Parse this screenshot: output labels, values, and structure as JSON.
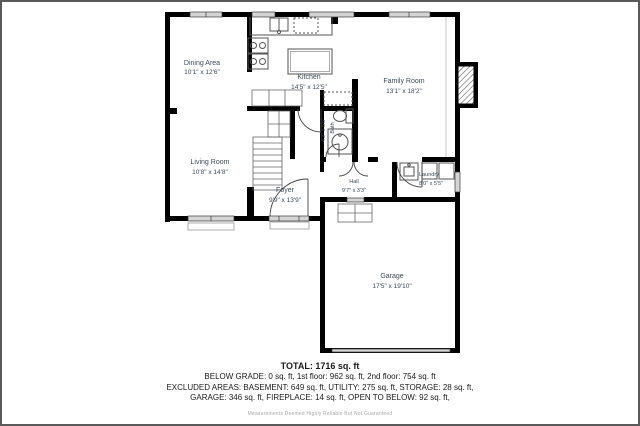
{
  "plan": {
    "rooms": {
      "dining": {
        "name": "Dining Area",
        "dims": "10'1\" x 12'6\""
      },
      "kitchen": {
        "name": "Kitchen",
        "dims": "14'5\" x 12'5\""
      },
      "family": {
        "name": "Family Room",
        "dims": "13'1\" x 18'2\""
      },
      "living": {
        "name": "Living Room",
        "dims": "10'8\" x 14'8\""
      },
      "foyer": {
        "name": "Foyer",
        "dims": "9'9\" x 13'9\""
      },
      "hall": {
        "name": "Hall",
        "dims": "9'7\" x 3'3\""
      },
      "bath": {
        "name": "Bath",
        "dims": "4'2\" x 5'5\""
      },
      "laundry": {
        "name": "Laundry",
        "dims": "8'0\" x 5'5\""
      },
      "garage": {
        "name": "Garage",
        "dims": "17'5\" x 19'10\""
      }
    },
    "colors": {
      "wall": "#000000",
      "label": "#3d4a5c",
      "window": "#d4d4d4",
      "border": "#5a5a5a"
    }
  },
  "summary": {
    "total": "TOTAL: 1716 sq. ft",
    "line1": "BELOW GRADE: 0 sq. ft, 1st floor: 962 sq. ft, 2nd floor: 754 sq. ft",
    "line2": "EXCLUDED AREAS: BASEMENT: 649 sq. ft, UTILITY: 275 sq. ft, STORAGE: 28 sq. ft,",
    "line3": "GARAGE: 346 sq. ft, FIREPLACE: 14 sq. ft, OPEN TO BELOW: 92 sq. ft,"
  },
  "disclaimer": "Measurements Deemed Highly Reliable But Not Guaranteed"
}
